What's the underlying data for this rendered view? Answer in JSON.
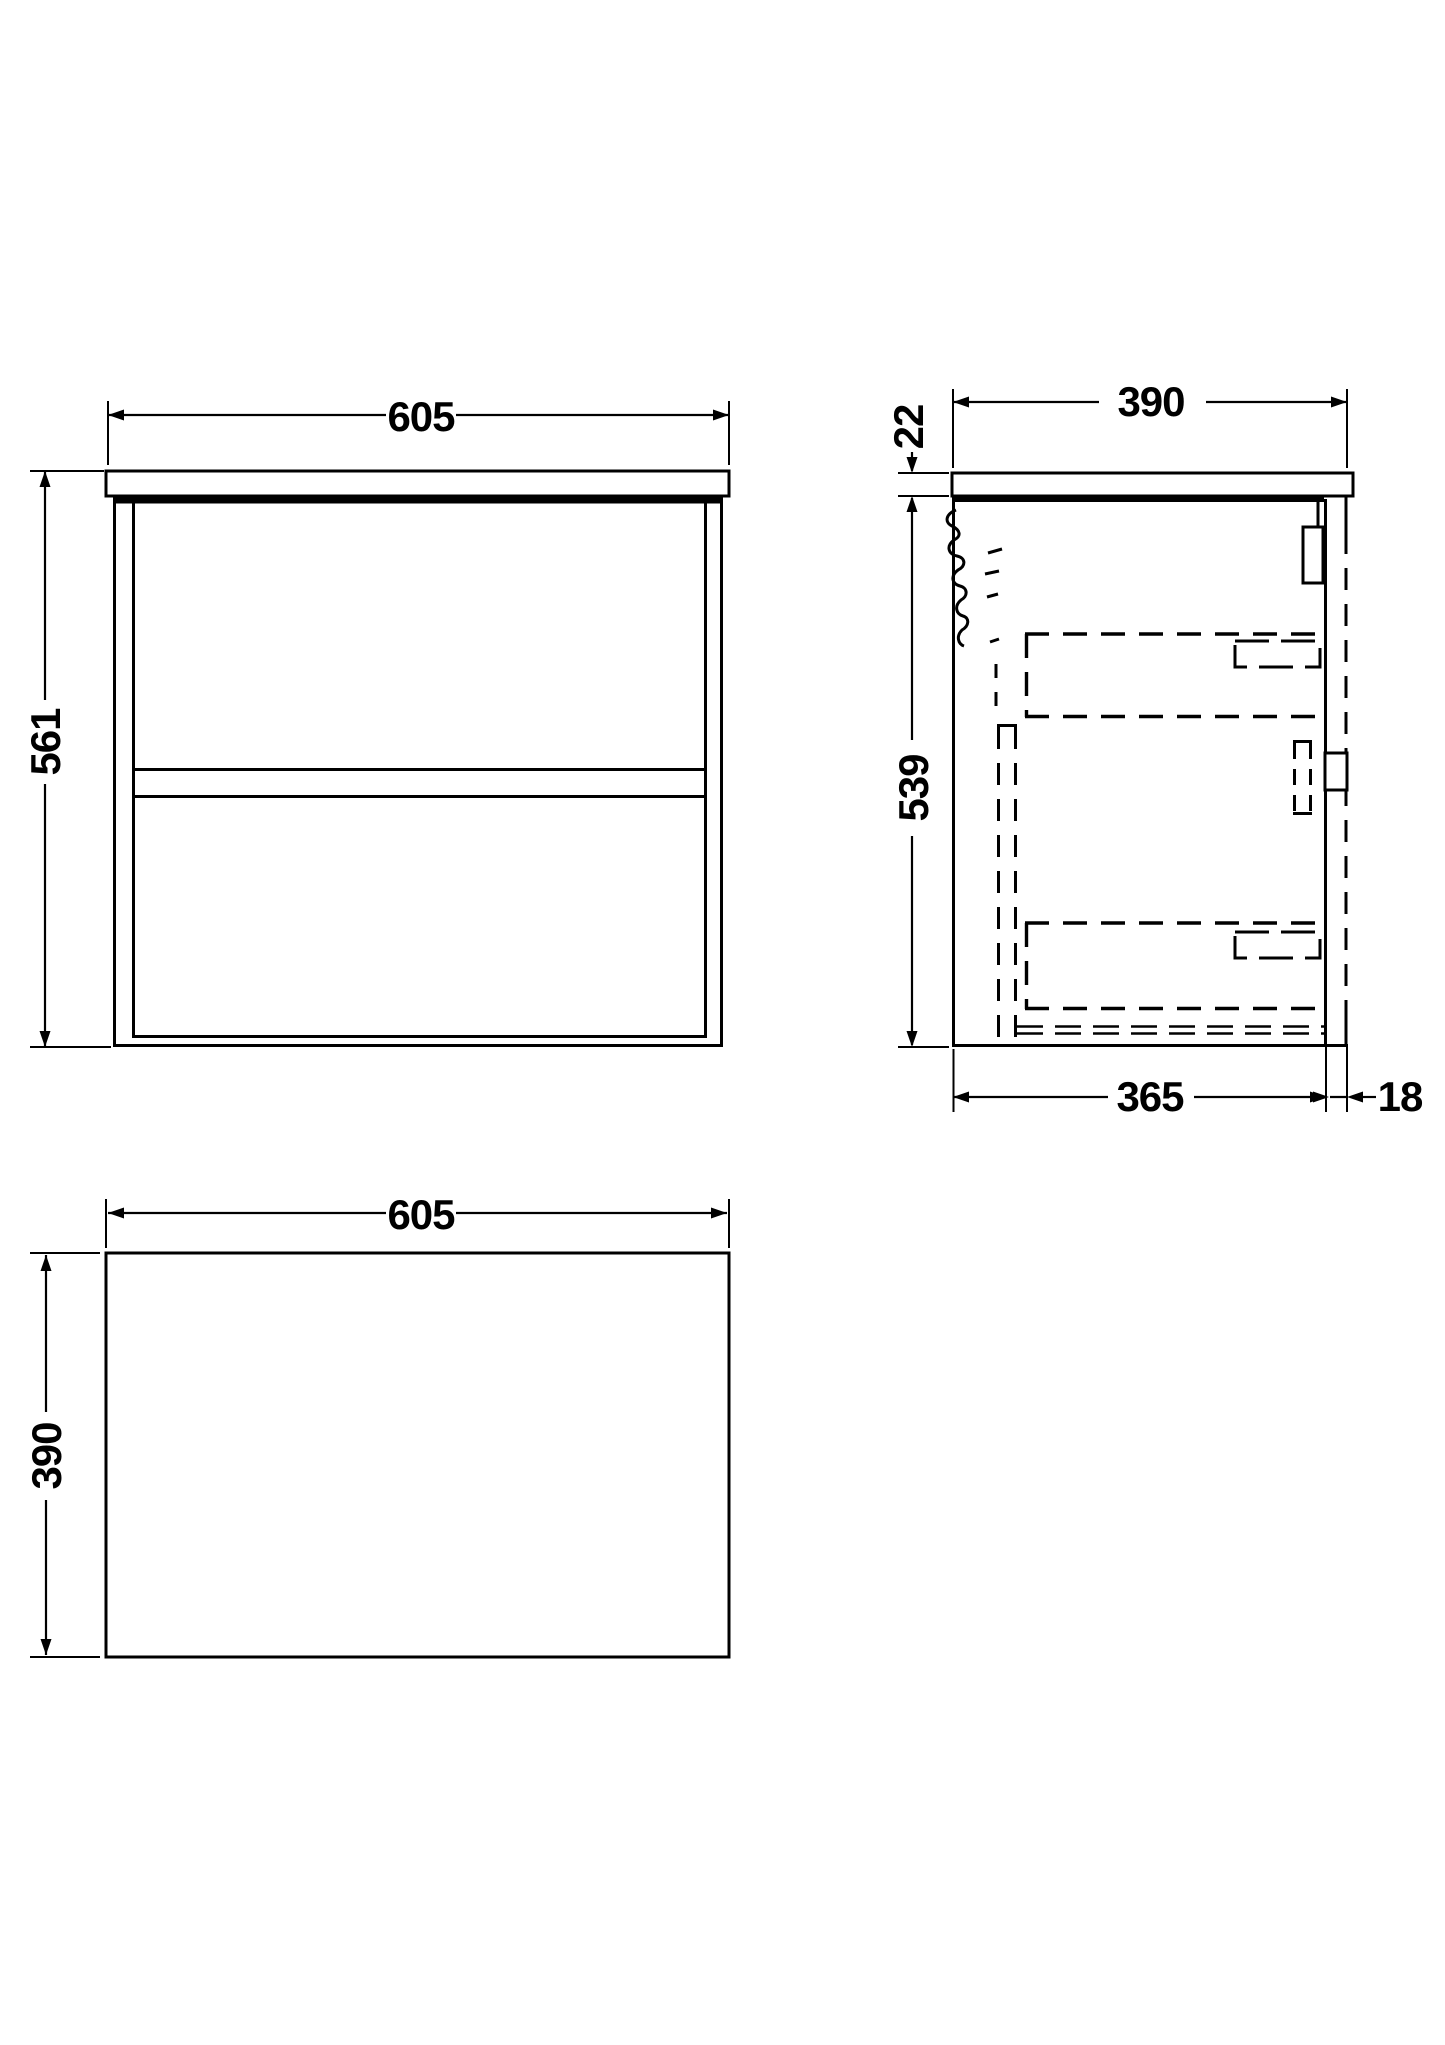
{
  "drawing": {
    "background_color": "#ffffff",
    "line_color": "#000000",
    "front_view": {
      "width_dim": "605",
      "height_dim": "561"
    },
    "side_view": {
      "depth_dim": "390",
      "worktop_thickness_dim": "22",
      "cabinet_height_dim": "539",
      "cabinet_depth_dim": "365",
      "front_panel_dim": "18"
    },
    "plan_view": {
      "width_dim": "605",
      "depth_dim": "390"
    }
  }
}
